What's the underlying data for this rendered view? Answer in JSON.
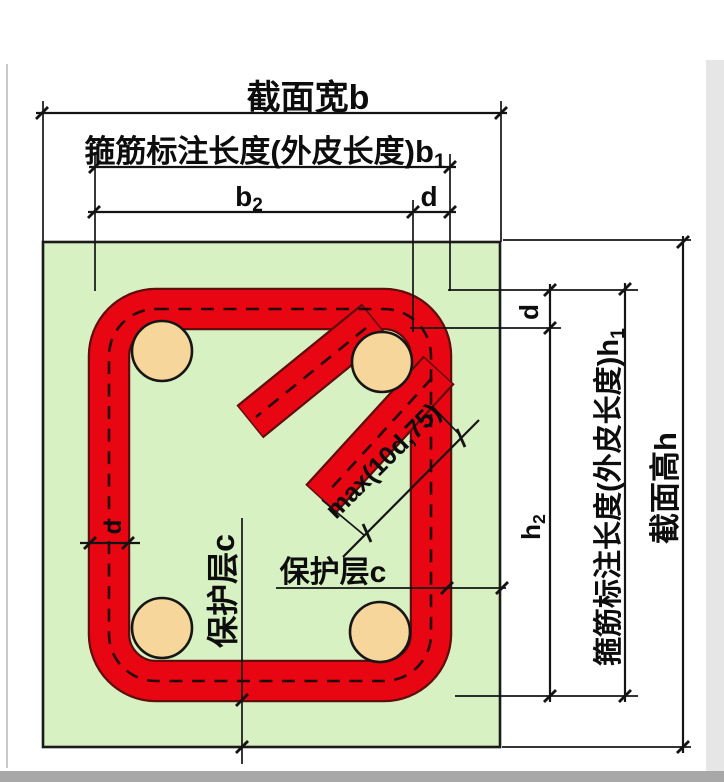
{
  "diagram": {
    "colors": {
      "concrete": "#d8f1c3",
      "concrete_stroke": "#1b1b1b",
      "stirrup": "#e90613",
      "stirrup_outline": "#5f0d0d",
      "dash": "#230707",
      "rebar": "#f6d69b",
      "rebar_stroke": "#161616",
      "ink": "#141414",
      "shadow": "#a8a8a8"
    },
    "labels": {
      "section_width": "截面宽b",
      "stirrup_len_b1_main": "箍筋标注长度(外皮长度)b",
      "stirrup_len_b1_sub": "1",
      "b2_main": "b",
      "b2_sub": "2",
      "d_top": "d",
      "section_height": "截面高h",
      "stirrup_len_h1_main": "箍筋标注长度(外皮长度)h",
      "stirrup_len_h1_sub": "1",
      "d_right": "d",
      "h2_main": "h",
      "h2_sub": "2",
      "cover_horizontal": "保护层c",
      "cover_vertical": "保护层c",
      "d_left": "d",
      "hook_extension": "max(10d,75)"
    }
  }
}
